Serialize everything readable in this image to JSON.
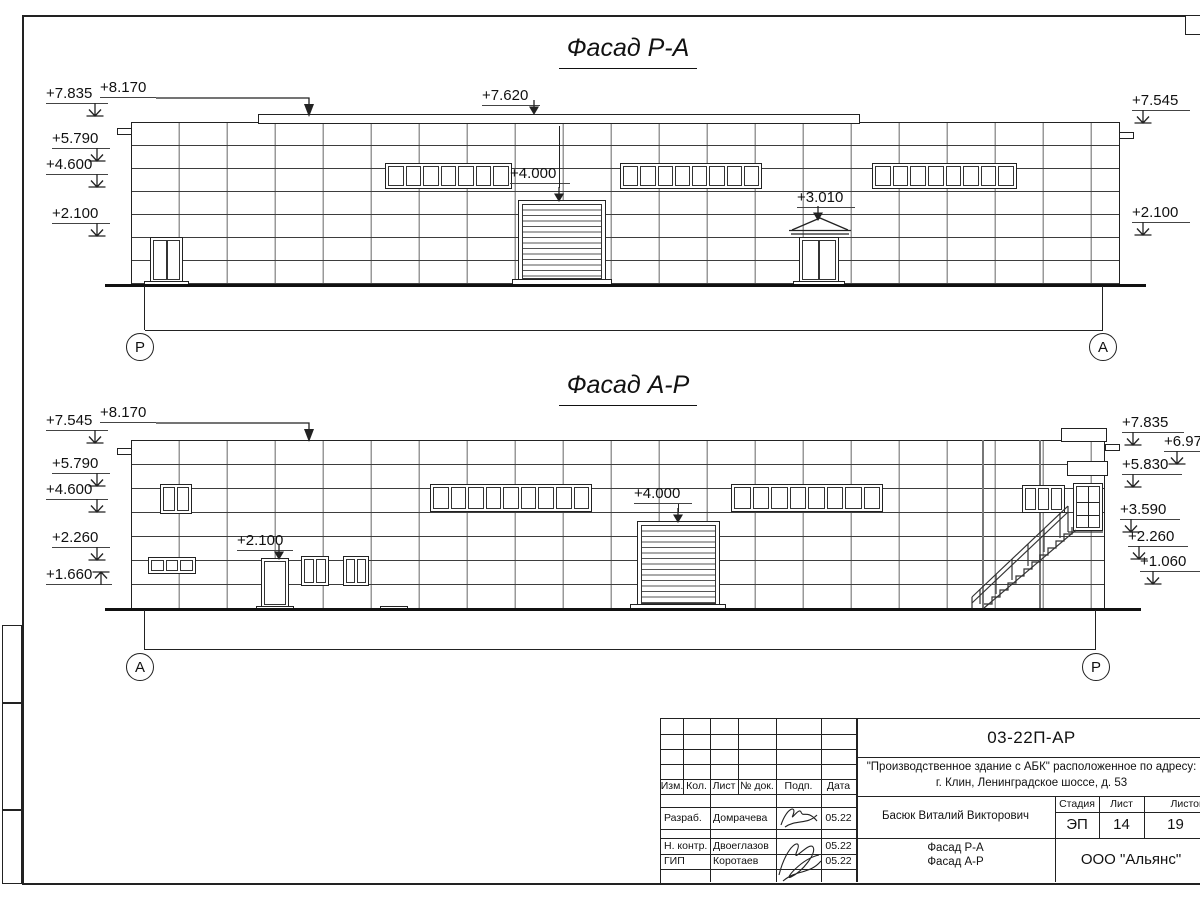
{
  "colors": {
    "ink": "#222222",
    "grid_light": "#999999"
  },
  "facade_top": {
    "title": "Фасад Р-А",
    "axis_left": "Р",
    "axis_right": "А",
    "marks": {
      "left_7835": "+7.835",
      "left_8170": "+8.170",
      "left_5790": "+5.790",
      "left_4600": "+4.600",
      "left_2100": "+2.100",
      "mid_7620": "+7.620",
      "mid_4000": "+4.000",
      "mid_3010": "+3.010",
      "right_7545": "+7.545",
      "right_2100": "+2.100"
    },
    "windows": {
      "ribbon1": 7,
      "ribbon2": 8,
      "ribbon3": 8
    }
  },
  "facade_bottom": {
    "title": "Фасад А-Р",
    "axis_left": "А",
    "axis_right": "Р",
    "marks": {
      "left_7545": "+7.545",
      "left_8170": "+8.170",
      "left_5790": "+5.790",
      "left_4600": "+4.600",
      "left_2260": "+2.260",
      "left_1660": "+1.660",
      "mid_2100": "+2.100",
      "mid_4000": "+4.000",
      "right_7835": "+7.835",
      "right_697": "+6.97",
      "right_5830": "+5.830",
      "right_3590": "+3.590",
      "right_2260": "+2.260",
      "right_1060": "+1.060"
    },
    "windows": {
      "small_window": 2,
      "low_window": 3,
      "window_a": 2,
      "window_b": 2,
      "ribbon1": 9,
      "ribbon2": 8,
      "stair_window": 3
    }
  },
  "title_block": {
    "doc_number": "03-22П-АР",
    "project_line1": "\"Производственное здание с АБК\" расположенное по адресу:",
    "project_line2": "г. Клин, Ленинградское шоссе, д. 53",
    "cols": {
      "izm": "Изм.",
      "kol": "Кол.",
      "list": "Лист",
      "ndok": "№ док.",
      "podp": "Подп.",
      "data": "Дата"
    },
    "razrab_label": "Разраб.",
    "razrab_name": "Домрачева",
    "razrab_date": "05.22",
    "nkontr_label": "Н. контр.",
    "nkontr_name": "Двоеглазов",
    "nkontr_date": "05.22",
    "gip_label": "ГИП",
    "gip_name": "Коротаев",
    "gip_date": "05.22",
    "author": "Басюк Виталий Викторович",
    "stage_label": "Стадия",
    "sheet_label": "Лист",
    "sheets_label": "Листов",
    "stage_value": "ЭП",
    "sheet_value": "14",
    "sheets_value": "19",
    "drawing_name1": "Фасад Р-А",
    "drawing_name2": "Фасад А-Р",
    "company": "ООО \"Альянс\""
  }
}
